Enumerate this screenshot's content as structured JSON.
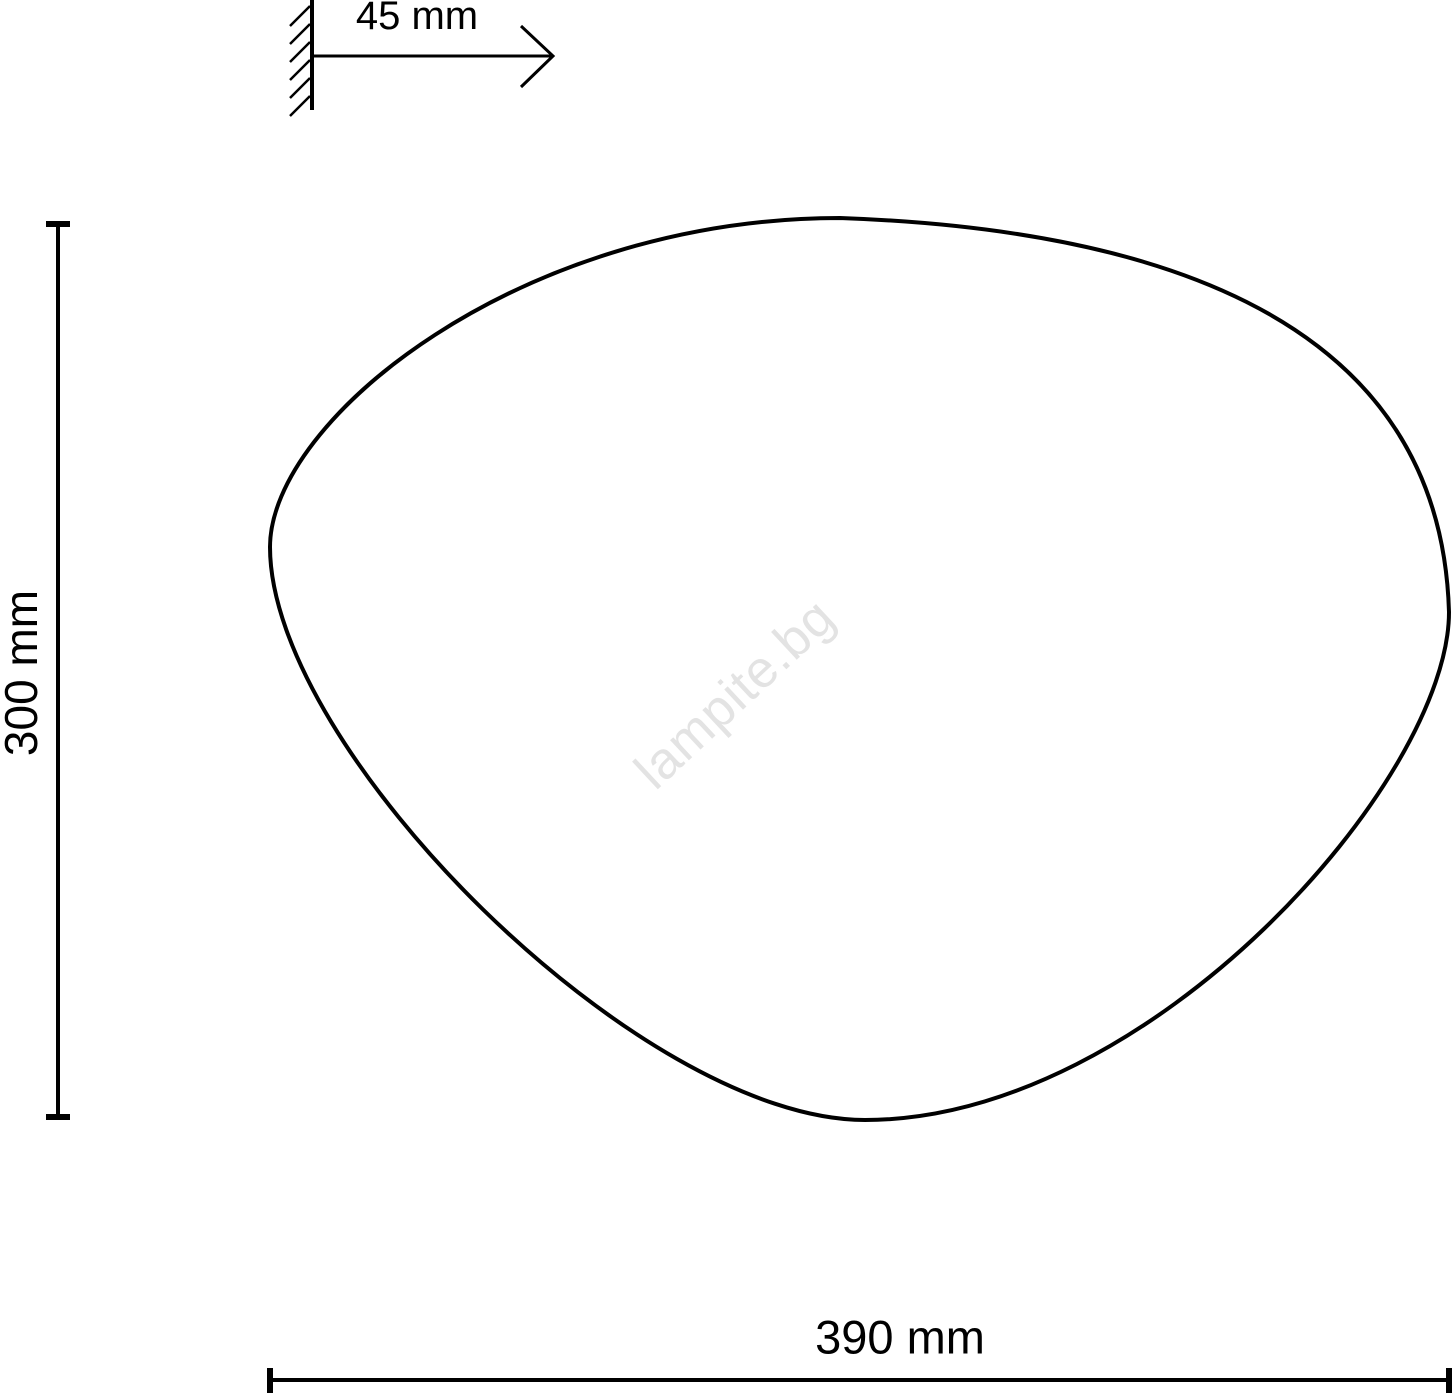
{
  "labels": {
    "depth": "45 mm",
    "height": "300 mm",
    "width": "390 mm"
  },
  "watermark": {
    "text": "lampite.bg",
    "color": "#e3e3e3"
  },
  "colors": {
    "line": "#000000",
    "text": "#000000",
    "background": "#ffffff"
  }
}
